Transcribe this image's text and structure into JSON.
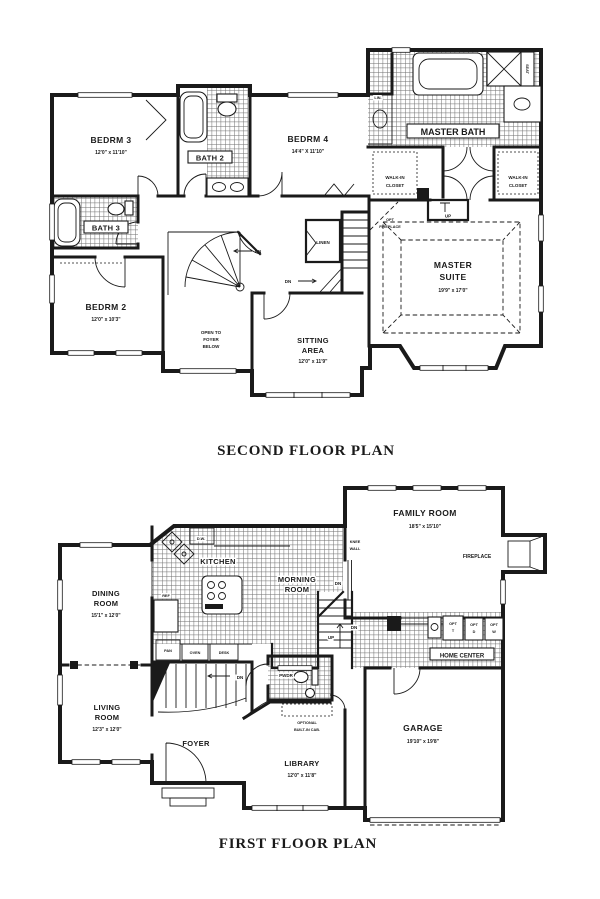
{
  "colors": {
    "ink": "#1a1a1a",
    "paper": "#ffffff"
  },
  "second_floor": {
    "title": "SECOND FLOOR PLAN",
    "bedrm3_name": "BEDRM 3",
    "bedrm3_dims": "12'0\" x 11'10\"",
    "bath2_name": "BATH 2",
    "bedrm4_name": "BEDRM 4",
    "bedrm4_dims": "14'4\" X 11'10\"",
    "master_bath_name": "MASTER BATH",
    "lin_label": "LIN.",
    "seat_label": "SEAT",
    "wic_line1": "WALK-IN",
    "wic_line2": "CLOSET",
    "bath3_name": "BATH 3",
    "bedrm2_name": "BEDRM 2",
    "bedrm2_dims": "12'0\" x 10'3\"",
    "open_line1": "OPEN TO",
    "open_line2": "FOYER",
    "open_line3": "BELOW",
    "linen_label": "LINEN",
    "sitting_line1": "SITTING",
    "sitting_line2": "AREA",
    "sitting_dims": "12'0\" x 11'9\"",
    "master_line1": "MASTER",
    "master_line2": "SUITE",
    "master_dims": "19'9\" x 17'0\"",
    "optfp_line1": "OPT",
    "optfp_line2": "FIREPLACE",
    "up_label": "UP",
    "dn_label": "DN"
  },
  "first_floor": {
    "title": "FIRST FLOOR PLAN",
    "family_name": "FAMILY ROOM",
    "family_dims": "18'5\" x 15'10\"",
    "fireplace_label": "FIREPLACE",
    "knee_line1": "KNEE",
    "knee_line2": "WALL",
    "dw_label": "D.W.",
    "kitchen_name": "KITCHEN",
    "morning_line1": "MORNING",
    "morning_line2": "ROOM",
    "ref_label": "REF",
    "pan_label": "PAN",
    "oven_label": "OVEN",
    "desk_label": "DESK",
    "dining_line1": "DINING",
    "dining_line2": "ROOM",
    "dining_dims": "15'1\" x 12'0\"",
    "living_line1": "LIVING",
    "living_line2": "ROOM",
    "living_dims": "12'3\" x 12'0\"",
    "foyer_name": "FOYER",
    "pwdr_name": "PWDR",
    "optcab_line1": "OPTIONAL",
    "optcab_line2": "BUILT-IN CAB.",
    "library_name": "LIBRARY",
    "library_dims": "12'0\" x 11'8\"",
    "garage_name": "GARAGE",
    "garage_dims": "19'10\" x 19'8\"",
    "home_center_label": "HOME CENTER",
    "optt_line1": "OPT",
    "optt_line2": "T",
    "optd_line1": "OPT",
    "optd_line2": "D",
    "optw_line1": "OPT",
    "optw_line2": "W",
    "up_label": "UP",
    "dn_label": "DN"
  }
}
